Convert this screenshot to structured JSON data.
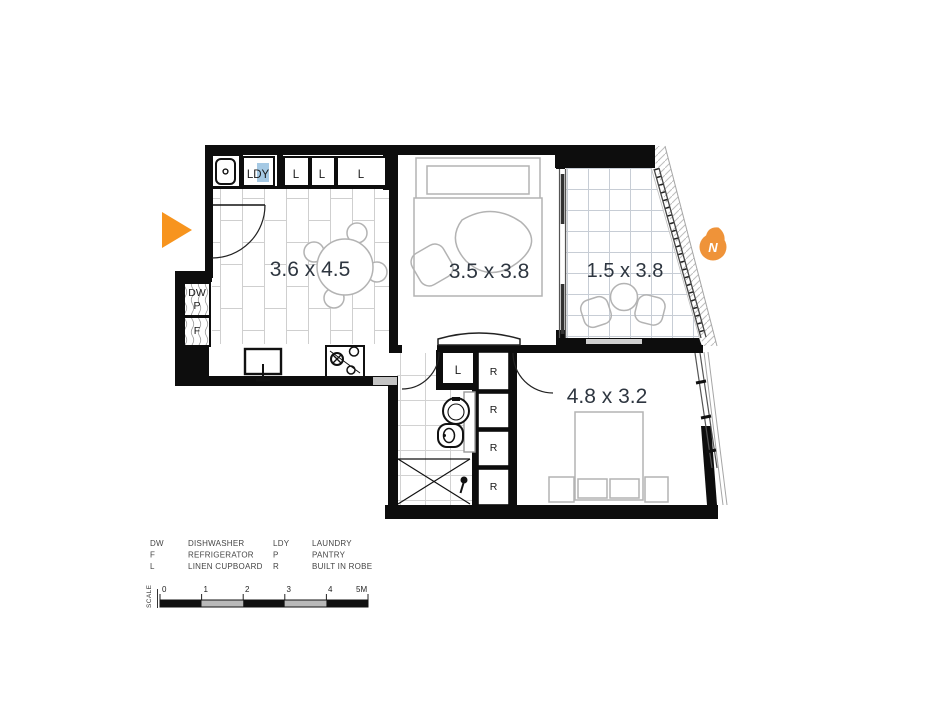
{
  "plan": {
    "room_labels": {
      "living_dining": "3.6 x 4.5",
      "bedroom_1": "3.5 x 3.8",
      "balcony": "1.5 x 3.8",
      "bedroom_2": "4.8 x 3.2"
    },
    "fixture_labels": {
      "laundry": "LDY",
      "linen_1": "L",
      "linen_2": "L",
      "linen_3": "L",
      "dishwasher": "DW",
      "pantry": "P",
      "fridge": "F",
      "linen_bath": "L",
      "robe_1": "R",
      "robe_2": "R",
      "robe_3": "R",
      "robe_4": "R"
    },
    "north_label": "N"
  },
  "legend": {
    "rows": [
      {
        "abbr_left": "DW",
        "term_left": "DISHWASHER",
        "abbr_right": "LDY",
        "term_right": "LAUNDRY"
      },
      {
        "abbr_left": "F",
        "term_left": "REFRIGERATOR",
        "abbr_right": "P",
        "term_right": "PANTRY"
      },
      {
        "abbr_left": "L",
        "term_left": "LINEN CUPBOARD",
        "abbr_right": "R",
        "term_right": "BUILT IN ROBE"
      }
    ]
  },
  "scale_bar": {
    "label": "SCALE",
    "ticks": [
      "0",
      "1",
      "2",
      "3",
      "4",
      "5M"
    ]
  },
  "colors": {
    "accent_orange": "#F7941E",
    "north_orange": "#EF9339",
    "highlight_blue": "#A5C9E4",
    "wall": "#0D0D0D",
    "dimension_text": "#2E3640",
    "scale_gray": "#B9B9B9"
  }
}
